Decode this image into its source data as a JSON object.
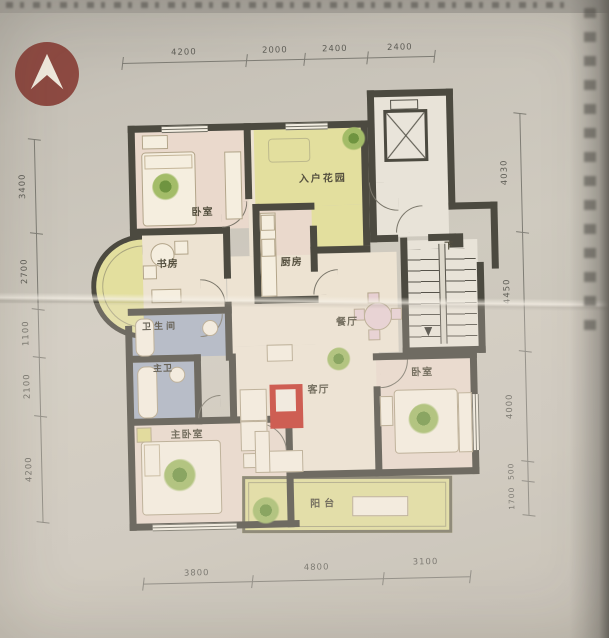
{
  "rooms": {
    "bedroom_tl": {
      "label": "卧室"
    },
    "entry_garden": {
      "label": "入户花园"
    },
    "study": {
      "label": "书房"
    },
    "kitchen": {
      "label": "厨房"
    },
    "bathroom": {
      "label": "卫生间"
    },
    "master_bath": {
      "label": "主卫"
    },
    "dining": {
      "label": "餐厅"
    },
    "living": {
      "label": "客厅"
    },
    "bedroom_r": {
      "label": "卧室"
    },
    "master_bedroom": {
      "label": "主卧室"
    },
    "balcony": {
      "label": "阳台"
    },
    "stairs_down": {
      "label": "下"
    }
  },
  "dimensions": {
    "top": [
      "4200",
      "2000",
      "2400",
      "2400"
    ],
    "left": [
      "3400",
      "2700",
      "1100",
      "2100",
      "4200"
    ],
    "right": [
      "4030",
      "4450",
      "4000",
      "500",
      "1700"
    ],
    "bottom": [
      "3800",
      "4800",
      "3100"
    ]
  },
  "colors": {
    "wall": "#4c4a40",
    "garden_yellow": "#e3df9e",
    "bath_blue": "#a9b2c3",
    "rug_red": "#c6392e",
    "logo_maroon": "#8d4a42"
  }
}
